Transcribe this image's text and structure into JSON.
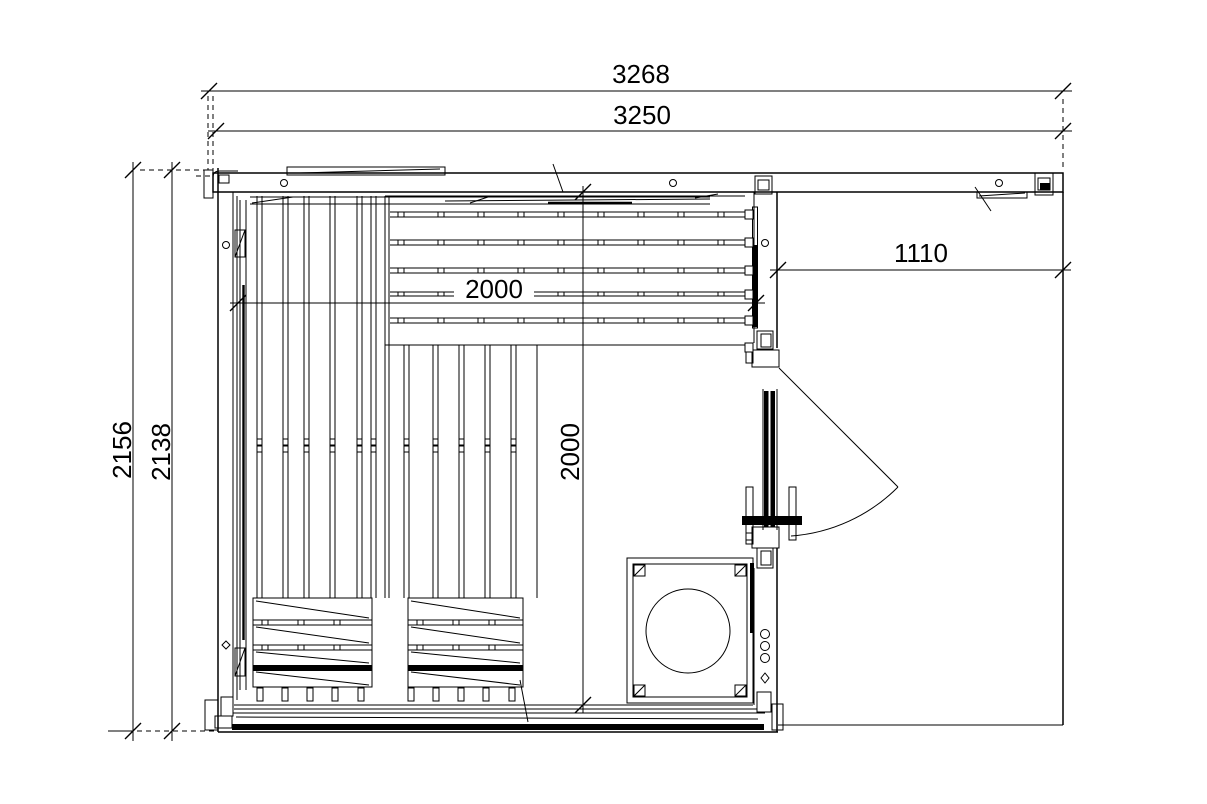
{
  "drawing": {
    "title": "sauna-floor-plan",
    "colors": {
      "line": "#000000",
      "background": "#ffffff"
    },
    "dims": {
      "overall_width": "3268",
      "cabin_width": "3250",
      "overall_depth": "2156",
      "cabin_depth": "2138",
      "bench_length": "2000",
      "room_depth": "2000",
      "front_section_width": "1110"
    }
  }
}
